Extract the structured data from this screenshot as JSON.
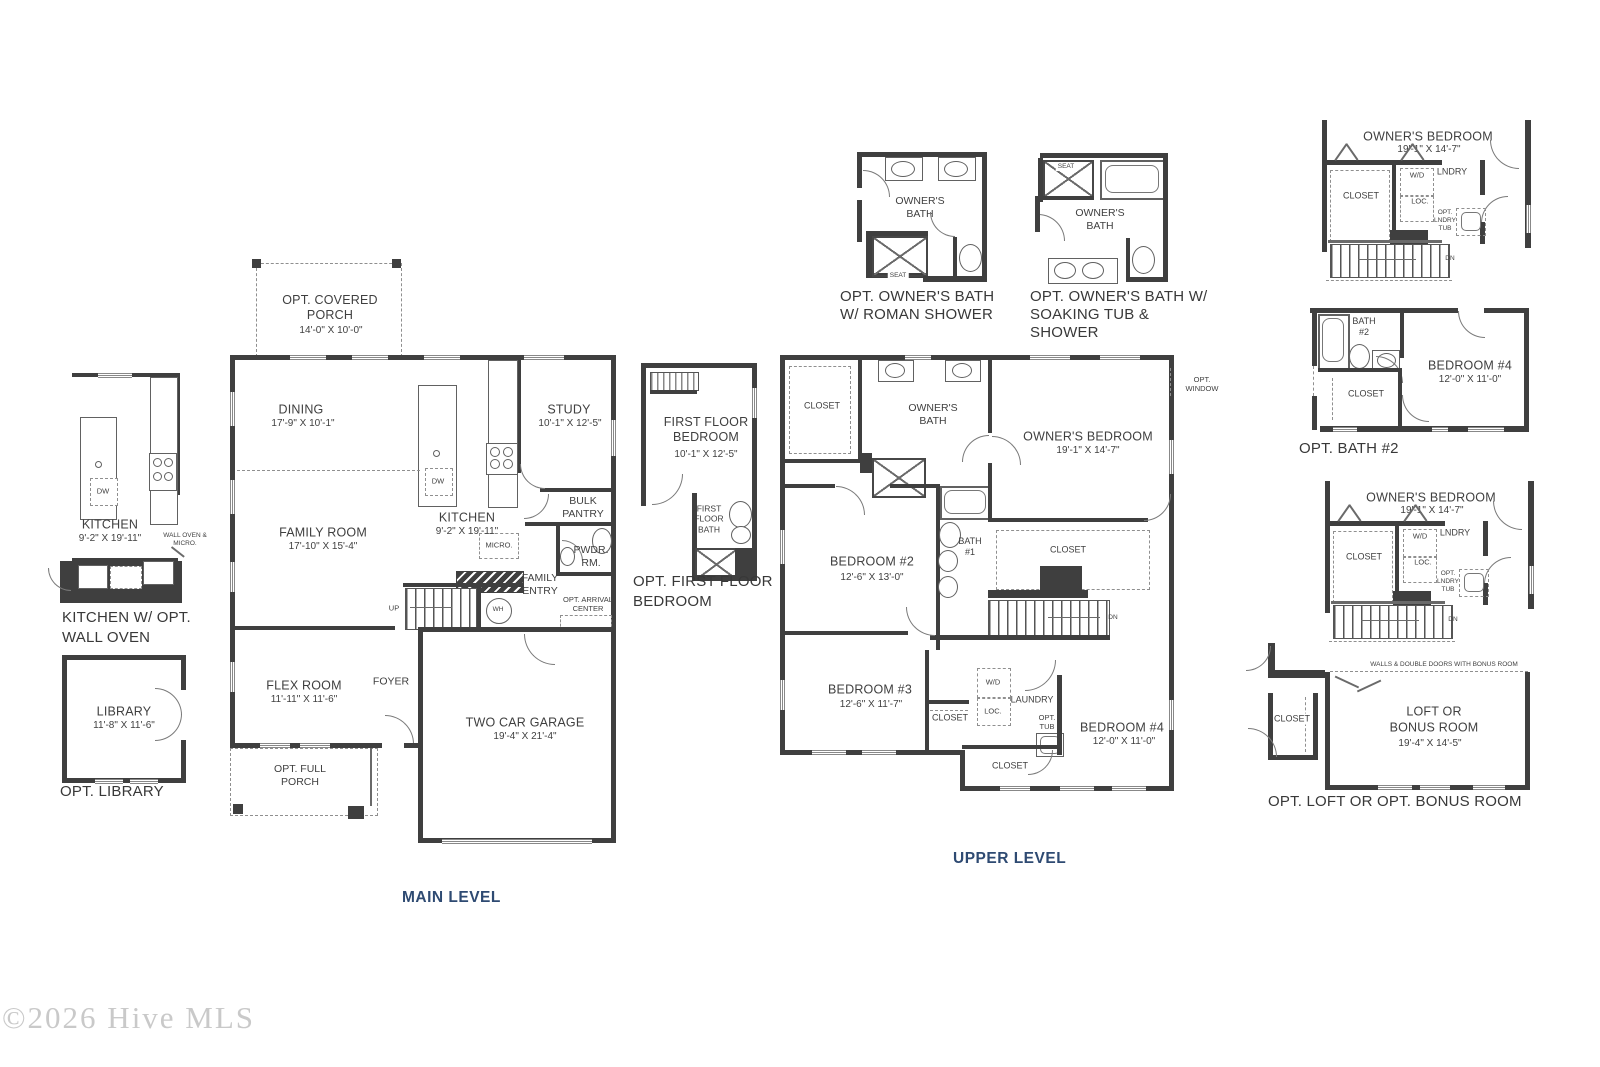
{
  "watermark": "©2026 Hive MLS",
  "levels": {
    "main": "MAIN LEVEL",
    "upper": "UPPER LEVEL"
  },
  "kitchen_opt": {
    "name": "KITCHEN",
    "dims": "9'-2\" X 19'-11\"",
    "dw": "DW",
    "note": "WALL OVEN & MICRO.",
    "caption": "KITCHEN W/ OPT. WALL OVEN"
  },
  "library_opt": {
    "name": "LIBRARY",
    "dims": "11'-8\" X 11'-6\"",
    "caption": "OPT. LIBRARY"
  },
  "main": {
    "porch": {
      "name": "OPT. COVERED PORCH",
      "dims": "14'-0\" X 10'-0\""
    },
    "dining": {
      "name": "DINING",
      "dims": "17'-9\" X 10'-1\""
    },
    "study": {
      "name": "STUDY",
      "dims": "10'-1\" X 12'-5\""
    },
    "family": {
      "name": "FAMILY ROOM",
      "dims": "17'-10\" X 15'-4\""
    },
    "kitchen": {
      "name": "KITCHEN",
      "dims": "9'-2\" X 19'-11\""
    },
    "bulk_pantry": "BULK PANTRY",
    "pwdr": "PWDR. RM.",
    "family_entry": "FAMILY ENTRY",
    "arrival": "OPT. ARRIVAL CENTER",
    "flex": {
      "name": "FLEX ROOM",
      "dims": "11'-11\" X 11'-6\""
    },
    "foyer": "FOYER",
    "garage": {
      "name": "TWO CAR GARAGE",
      "dims": "19'-4\" X 21'-4\""
    },
    "full_porch": "OPT. FULL PORCH",
    "up": "UP",
    "wh": "WH",
    "dw": "DW",
    "micro": "MICRO."
  },
  "ff_bedroom": {
    "name": "FIRST FLOOR BEDROOM",
    "dims": "10'-1\" X 12'-5\"",
    "bath": "FIRST FLOOR BATH",
    "caption": "OPT. FIRST FLOOR BEDROOM"
  },
  "bath_roman": {
    "room": "OWNER'S BATH",
    "seat": "SEAT",
    "caption1": "OPT. OWNER'S BATH",
    "caption2": "W/ ROMAN SHOWER"
  },
  "bath_soaking": {
    "room": "OWNER'S BATH",
    "seat": "SEAT",
    "caption1": "OPT. OWNER'S BATH W/",
    "caption2": "SOAKING TUB &",
    "caption3": "SHOWER"
  },
  "upper": {
    "owners_bed": {
      "name": "OWNER'S BEDROOM",
      "dims": "19'-1\" X 14'-7\""
    },
    "owners_bath": "OWNER'S BATH",
    "closet": "CLOSET",
    "bed2": {
      "name": "BEDROOM #2",
      "dims": "12'-6\" X 13'-0\""
    },
    "bath1": "BATH #1",
    "bed3": {
      "name": "BEDROOM #3",
      "dims": "12'-6\" X 11'-7\""
    },
    "bed4": {
      "name": "BEDROOM #4",
      "dims": "12'-0\" X 11'-0\""
    },
    "laundry": "LAUNDRY",
    "wd": "W/D",
    "loc": "LOC.",
    "opt_tub": "OPT. TUB",
    "dn": "DN",
    "opt_window": "OPT. WINDOW"
  },
  "owners_suite_opt": {
    "name": "OWNER'S BEDROOM",
    "dims": "19'-1\" X 14'-7\"",
    "closet": "CLOSET",
    "wd": "W/D",
    "lndry": "LNDRY",
    "loc": "LOC.",
    "opt_lndry_tub": "OPT. LNDRY TUB",
    "dn": "DN"
  },
  "bath2_opt": {
    "bath": "BATH #2",
    "bed4": {
      "name": "BEDROOM #4",
      "dims": "12'-0\" X 11'-0\""
    },
    "closet": "CLOSET",
    "caption": "OPT. BATH #2"
  },
  "loft_opt": {
    "note": "WALLS & DOUBLE DOORS WITH BONUS ROOM",
    "closet": "CLOSET",
    "name": "LOFT OR",
    "name2": "BONUS ROOM",
    "dims": "19'-4\" X 14'-5\"",
    "caption": "OPT. LOFT OR OPT. BONUS ROOM"
  }
}
